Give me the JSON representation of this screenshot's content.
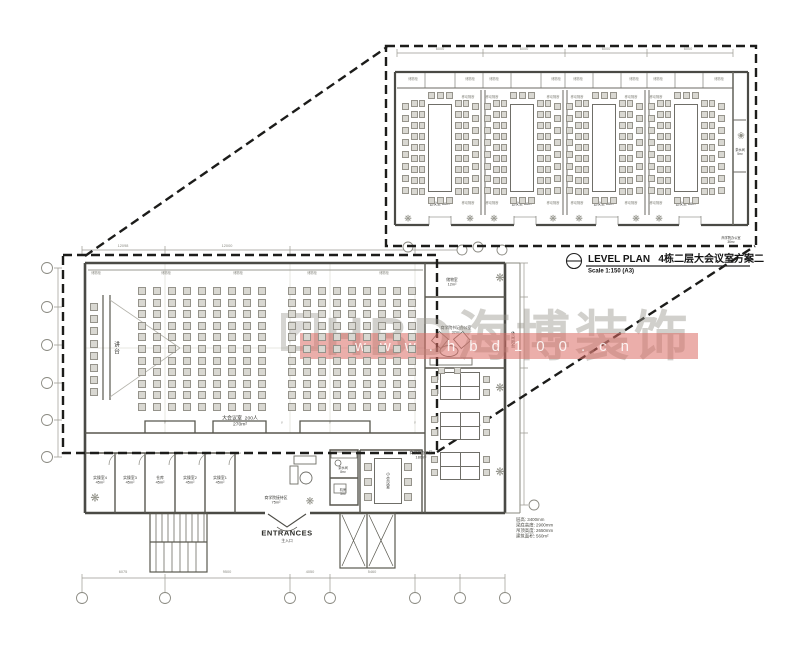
{
  "watermark": {
    "brand": "HBD海博装饰",
    "url": "www.hbd100.cn"
  },
  "title_block": {
    "heading": "LEVEL PLAN",
    "name": "4栋二层大会议室方案二",
    "scale": "Scale 1:150 (A3)"
  },
  "labels": {
    "cabinet": "储物柜",
    "partition": "移动隔断",
    "column_marker": "Y"
  },
  "inset": {
    "rooms": [
      {
        "name": "会议室",
        "area": "66m²"
      },
      {
        "name": "会议室",
        "area": "66m²"
      },
      {
        "name": "会议室",
        "area": "66m²"
      },
      {
        "name": "会议室",
        "area": "66m²"
      }
    ],
    "tea_room": {
      "name": "茶水间",
      "area": "5m²"
    },
    "corner_note": {
      "name": "商学院办公室",
      "area": "36m²"
    },
    "dims_top": [
      "6000",
      "6000",
      "6000",
      "6000"
    ]
  },
  "main": {
    "hall": {
      "name": "大会议室",
      "capacity": "200人",
      "area": "270m²",
      "stage": "讲台"
    },
    "rooms_bottom": [
      {
        "name": "实操室4",
        "area": "45m²"
      },
      {
        "name": "实操室3",
        "area": "45m²"
      },
      {
        "name": "仓库",
        "area": "45m²"
      },
      {
        "name": "实操室2",
        "area": "45m²"
      },
      {
        "name": "实操室1",
        "area": "45m²"
      }
    ],
    "reception": {
      "name": "商学院接待区",
      "area": "75m²"
    },
    "tea": {
      "name": "茶水间",
      "area": "8m²"
    },
    "machine": {
      "name": "机房",
      "area": "5m²"
    },
    "small_meeting": {
      "name": "小会议室",
      "area": "28m²"
    },
    "office_zone": {
      "name": "商学院办公区",
      "area": "180m²"
    },
    "secretary": {
      "name": "商学院书记办公室",
      "area": "32m²"
    },
    "storage": {
      "name": "储物室",
      "area": "12m²"
    },
    "balcony": "休闲阳台",
    "entrance": {
      "en": "ENTRANCES",
      "cn": "主入口"
    },
    "specs": [
      "层高: 3400mm",
      "梁底高度: 2900mm",
      "吊顶高度: 2650mm",
      "建筑面积: 560m²"
    ],
    "dims_top": [
      "12098",
      "12000"
    ],
    "dims_bottom": [
      "6075",
      "9500",
      "4050",
      "5460"
    ]
  },
  "icons": {
    "plant": "❋",
    "fan": "❀"
  }
}
